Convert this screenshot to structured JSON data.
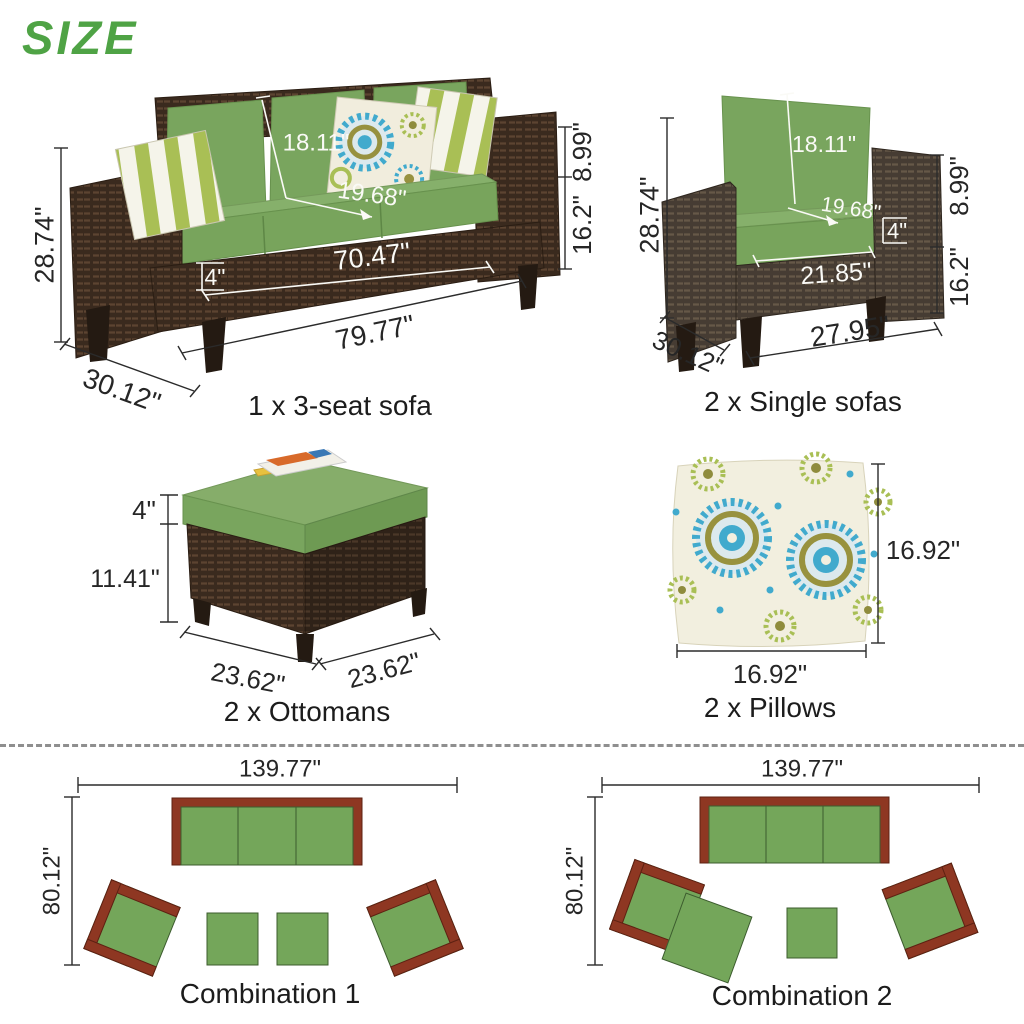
{
  "page": {
    "title": "SIZE"
  },
  "colors": {
    "title_green": "#4fa345",
    "cushion_green": "#78a45c",
    "wicker_brown": "#3d2c20",
    "plan_green": "#74a65a",
    "plan_brown": "#8e3722",
    "pillow_teal": "#41aacd",
    "pillow_lime": "#a9bf55",
    "dimension_text": "#262626",
    "dimension_text_on_photo": "#ffffff"
  },
  "sofa3": {
    "caption": "1 x 3-seat sofa",
    "dims": {
      "total_height": "28.74\"",
      "back_cushion_height": "18.11\"",
      "arm_to_seat": "8.99\"",
      "seat_height": "16.2\"",
      "seat_depth": "19.68\"",
      "cushion_thickness": "4\"",
      "inner_width": "70.47\"",
      "total_width": "79.77\"",
      "depth": "30.12\""
    }
  },
  "single_sofa": {
    "caption": "2 x Single sofas",
    "dims": {
      "total_height": "28.74\"",
      "back_cushion_height": "18.11\"",
      "arm_to_seat": "8.99\"",
      "seat_height": "16.2\"",
      "seat_depth": "19.68\"",
      "cushion_thickness": "4\"",
      "inner_width": "21.85\"",
      "total_width": "27.95\"",
      "depth": "30.12\""
    }
  },
  "ottoman": {
    "caption": "2 x Ottomans",
    "dims": {
      "cushion_thickness": "4\"",
      "base_height": "11.41\"",
      "width": "23.62\"",
      "depth": "23.62\""
    }
  },
  "pillow": {
    "caption": "2 x Pillows",
    "dims": {
      "height": "16.92\"",
      "width": "16.92\""
    }
  },
  "combination1": {
    "caption": "Combination 1",
    "dims": {
      "width": "139.77\"",
      "depth": "80.12\""
    }
  },
  "combination2": {
    "caption": "Combination 2",
    "dims": {
      "width": "139.77\"",
      "depth": "80.12\""
    }
  }
}
